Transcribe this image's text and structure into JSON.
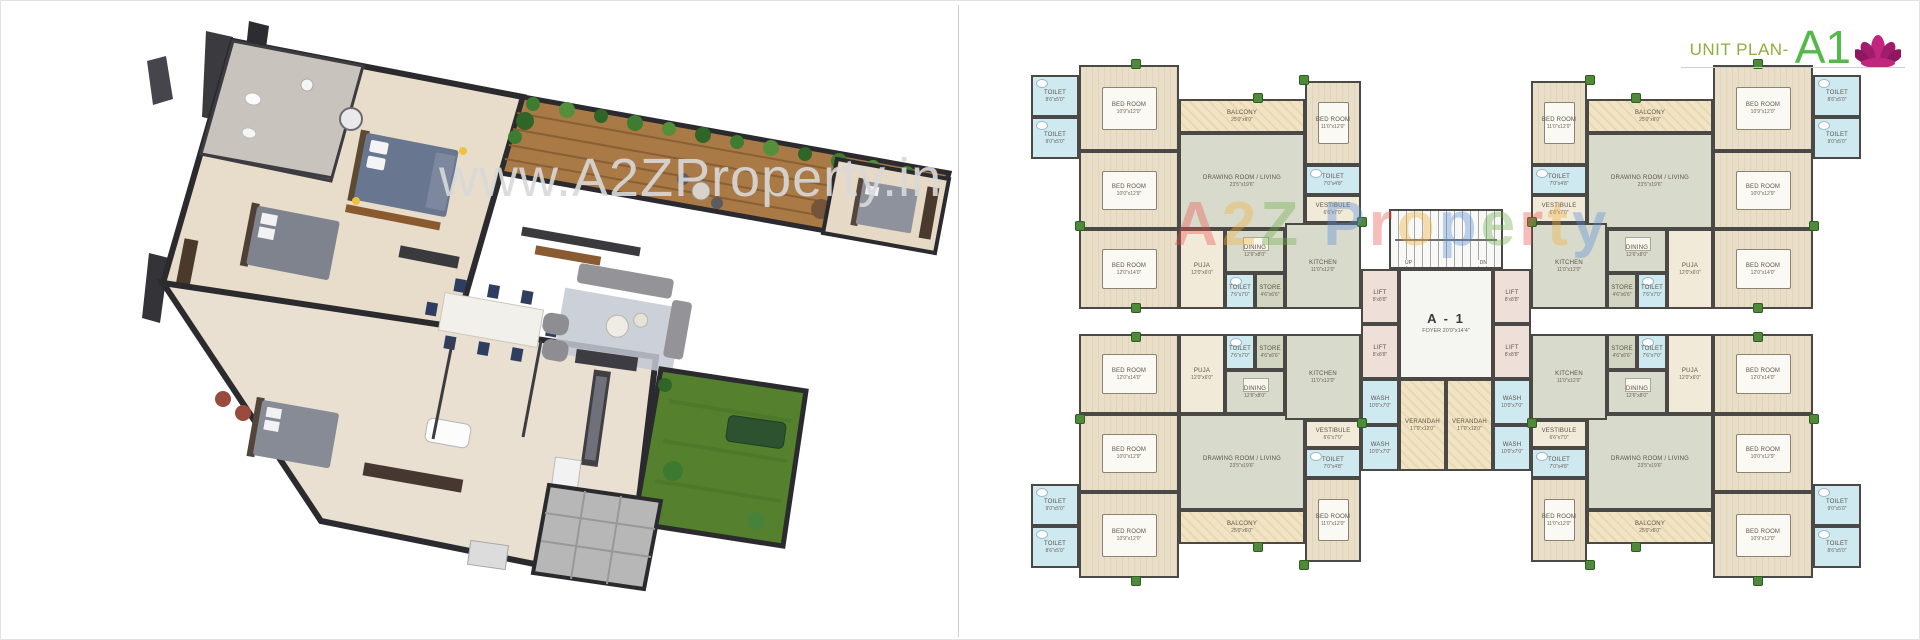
{
  "header": {
    "label": "UNIT PLAN-",
    "code": "A1",
    "label_color": "#8fae3c",
    "code_color": "#55b848",
    "logo_color": "#bb2a7c"
  },
  "watermarks": {
    "photo": "www.A2ZProperty.in",
    "plan_letters": [
      {
        "ch": "A",
        "color": "#e8574c"
      },
      {
        "ch": "2",
        "color": "#f2b03f"
      },
      {
        "ch": "Z",
        "color": "#6fae4e"
      },
      {
        "ch": " ",
        "color": "#000000"
      },
      {
        "ch": "P",
        "color": "#5b8fd6"
      },
      {
        "ch": "r",
        "color": "#e8574c"
      },
      {
        "ch": "o",
        "color": "#f2b03f"
      },
      {
        "ch": "p",
        "color": "#5b8fd6"
      },
      {
        "ch": "e",
        "color": "#6fae4e"
      },
      {
        "ch": "r",
        "color": "#e8574c"
      },
      {
        "ch": "t",
        "color": "#f2b03f"
      },
      {
        "ch": "y",
        "color": "#5b8fd6"
      }
    ]
  },
  "plan": {
    "unit_w": 330,
    "unit_h": 250,
    "quadrants": [
      {
        "id": "top-left",
        "dx": 0,
        "dy": 0,
        "fx": false,
        "fy": false
      },
      {
        "id": "top-right",
        "dx": 500,
        "dy": 0,
        "fx": true,
        "fy": false
      },
      {
        "id": "bottom-left",
        "dx": 0,
        "dy": 275,
        "fx": false,
        "fy": true
      },
      {
        "id": "bottom-right",
        "dx": 500,
        "dy": 275,
        "fx": true,
        "fy": true
      }
    ],
    "unit_rooms": [
      {
        "name": "toilet-a",
        "label": "TOILET",
        "dim": "8'6\"x5'0\"",
        "x": 0,
        "y": 16,
        "w": 48,
        "h": 42,
        "fill": "blue",
        "type": "toilet"
      },
      {
        "name": "toilet-b",
        "label": "TOILET",
        "dim": "9'0\"x5'0\"",
        "x": 0,
        "y": 58,
        "w": 48,
        "h": 42,
        "fill": "blue",
        "type": "toilet"
      },
      {
        "name": "bedroom-1",
        "label": "BED ROOM",
        "dim": "10'9\"x12'0\"",
        "x": 48,
        "y": 6,
        "w": 100,
        "h": 86,
        "fill": "wood",
        "type": "bed"
      },
      {
        "name": "bedroom-2",
        "label": "BED ROOM",
        "dim": "10'0\"x12'9\"",
        "x": 48,
        "y": 92,
        "w": 100,
        "h": 78,
        "fill": "wood",
        "type": "bed"
      },
      {
        "name": "bedroom-3",
        "label": "BED ROOM",
        "dim": "12'0\"x14'0\"",
        "x": 48,
        "y": 170,
        "w": 100,
        "h": 80,
        "fill": "wood",
        "type": "bed"
      },
      {
        "name": "balcony",
        "label": "BALCONY",
        "dim": "25'0\"x6'0\"",
        "x": 148,
        "y": 40,
        "w": 126,
        "h": 34,
        "fill": "tan",
        "type": "plain"
      },
      {
        "name": "living",
        "label": "DRAWING ROOM / LIVING",
        "dim": "23'5\"x19'6\"",
        "x": 148,
        "y": 74,
        "w": 126,
        "h": 96,
        "fill": "sage",
        "type": "plain"
      },
      {
        "name": "bedroom-4",
        "label": "BED ROOM",
        "dim": "11'0\"x12'0\"",
        "x": 274,
        "y": 22,
        "w": 56,
        "h": 84,
        "fill": "wood",
        "type": "bed"
      },
      {
        "name": "toilet-c",
        "label": "TOILET",
        "dim": "7'0\"x4'8\"",
        "x": 274,
        "y": 106,
        "w": 56,
        "h": 30,
        "fill": "blue",
        "type": "toilet"
      },
      {
        "name": "vestibule",
        "label": "VESTIBULE",
        "dim": "6'6\"x7'0\"",
        "x": 274,
        "y": 136,
        "w": 56,
        "h": 28,
        "fill": "cream",
        "type": "plain"
      },
      {
        "name": "puja",
        "label": "PUJA",
        "dim": "12'0\"x6'0\"",
        "x": 148,
        "y": 170,
        "w": 46,
        "h": 80,
        "fill": "cream",
        "type": "plain"
      },
      {
        "name": "dining",
        "label": "DINING",
        "dim": "12'6\"x8'0\"",
        "x": 194,
        "y": 170,
        "w": 60,
        "h": 44,
        "fill": "sage",
        "type": "table"
      },
      {
        "name": "toilet-d",
        "label": "TOILET",
        "dim": "7'6\"x7'0\"",
        "x": 194,
        "y": 214,
        "w": 30,
        "h": 36,
        "fill": "blue",
        "type": "toilet"
      },
      {
        "name": "store",
        "label": "STORE",
        "dim": "4'6\"x6'6\"",
        "x": 224,
        "y": 214,
        "w": 30,
        "h": 36,
        "fill": "store",
        "type": "plain"
      },
      {
        "name": "kitchen",
        "label": "KITCHEN",
        "dim": "11'0\"x12'0\"",
        "x": 254,
        "y": 164,
        "w": 76,
        "h": 86,
        "fill": "sage",
        "type": "plain"
      }
    ],
    "core_rooms": [
      {
        "name": "stairs",
        "label": "",
        "dim": "",
        "x": 358,
        "y": 150,
        "w": 114,
        "h": 60,
        "fill": "stairs",
        "type": "stairs"
      },
      {
        "name": "lift-1",
        "label": "LIFT",
        "dim": "8'x8'8\"",
        "x": 330,
        "y": 210,
        "w": 38,
        "h": 55,
        "fill": "lift",
        "type": "plain"
      },
      {
        "name": "lift-2",
        "label": "LIFT",
        "dim": "8'x8'8\"",
        "x": 330,
        "y": 265,
        "w": 38,
        "h": 55,
        "fill": "lift",
        "type": "plain"
      },
      {
        "name": "foyer",
        "label": "A - 1",
        "dim": "FOYER 20'0\"x14'4\"",
        "x": 368,
        "y": 210,
        "w": 94,
        "h": 110,
        "fill": "white",
        "type": "foyer"
      },
      {
        "name": "lift-3",
        "label": "LIFT",
        "dim": "8'x8'8\"",
        "x": 462,
        "y": 210,
        "w": 38,
        "h": 55,
        "fill": "lift",
        "type": "plain"
      },
      {
        "name": "lift-4",
        "label": "LIFT",
        "dim": "8'x8'8\"",
        "x": 462,
        "y": 265,
        "w": 38,
        "h": 55,
        "fill": "lift",
        "type": "plain"
      },
      {
        "name": "wash-1",
        "label": "WASH",
        "dim": "10'0\"x7'0\"",
        "x": 330,
        "y": 320,
        "w": 38,
        "h": 46,
        "fill": "blue",
        "type": "plain"
      },
      {
        "name": "wash-2",
        "label": "WASH",
        "dim": "10'0\"x7'0\"",
        "x": 330,
        "y": 366,
        "w": 38,
        "h": 46,
        "fill": "blue",
        "type": "plain"
      },
      {
        "name": "verandah-1",
        "label": "VERANDAH",
        "dim": "17'0\"x12'0\"",
        "x": 368,
        "y": 320,
        "w": 47,
        "h": 92,
        "fill": "tan",
        "type": "plain"
      },
      {
        "name": "verandah-2",
        "label": "VERANDAH",
        "dim": "17'0\"x12'0\"",
        "x": 415,
        "y": 320,
        "w": 47,
        "h": 92,
        "fill": "tan",
        "type": "plain"
      },
      {
        "name": "wash-3",
        "label": "WASH",
        "dim": "10'0\"x7'0\"",
        "x": 462,
        "y": 320,
        "w": 38,
        "h": 46,
        "fill": "blue",
        "type": "plain"
      },
      {
        "name": "wash-4",
        "label": "WASH",
        "dim": "10'0\"x7'0\"",
        "x": 462,
        "y": 366,
        "w": 38,
        "h": 46,
        "fill": "blue",
        "type": "plain"
      }
    ],
    "stairs_labels": {
      "up": "UP",
      "dn": "DN"
    },
    "plants": [
      [
        100,
        0
      ],
      [
        222,
        34
      ],
      [
        44,
        162
      ],
      [
        100,
        244
      ],
      [
        268,
        16
      ],
      [
        326,
        158
      ],
      [
        722,
        0
      ],
      [
        600,
        34
      ],
      [
        778,
        162
      ],
      [
        722,
        244
      ],
      [
        554,
        16
      ],
      [
        496,
        158
      ],
      [
        100,
        517
      ],
      [
        222,
        483
      ],
      [
        44,
        355
      ],
      [
        100,
        273
      ],
      [
        268,
        501
      ],
      [
        326,
        359
      ],
      [
        722,
        517
      ],
      [
        600,
        483
      ],
      [
        778,
        355
      ],
      [
        722,
        273
      ],
      [
        554,
        501
      ],
      [
        496,
        359
      ]
    ]
  }
}
